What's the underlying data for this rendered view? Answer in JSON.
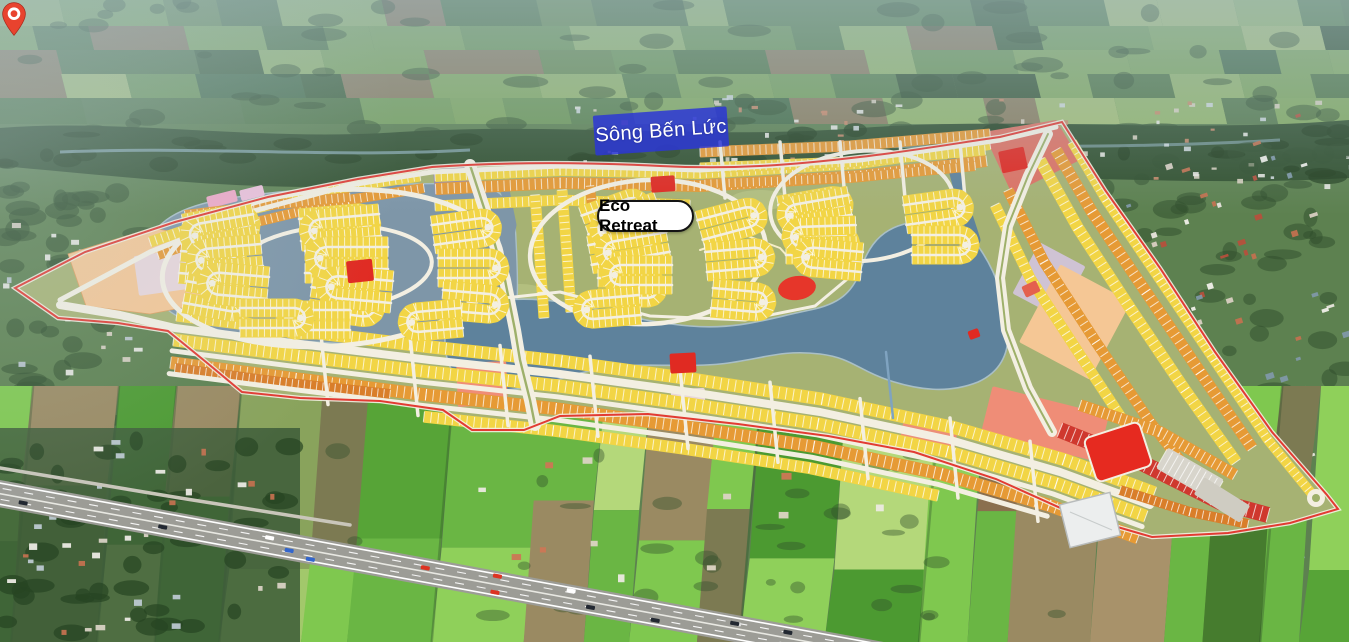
{
  "labels": {
    "river": {
      "text": "Sông Bến Lức"
    },
    "project": {
      "text": "Eco Retreat"
    }
  },
  "marker": {
    "type": "map-pin"
  },
  "palette": {
    "river_label_bg": "#2b36d6",
    "river_label_text": "#ffffff",
    "project_label_bg": "#ffffff",
    "project_label_border": "#141414",
    "project_label_text": "#000000",
    "pin_red": "#e8432e",
    "pin_ring": "#ffffff",
    "highlight_red": "#e6362a",
    "plan_base_green": "#a6b273",
    "lake_blue": "#5e829c",
    "lagoon_blue": "#7e96a8",
    "plot_yellow": "#f2d545",
    "plot_orange": "#e69a35",
    "plot_deep_orange": "#d97e2a",
    "road_cream": "#f3efe2",
    "boundary_red": "#e23b33",
    "red_block": "#e02a22",
    "salmon": "#ef8d77",
    "salmon_red": "#dd7263",
    "pink": "#f0a8c6",
    "light_pink": "#edc0da",
    "pale_pink": "#e8d6da",
    "peach": "#f5c795",
    "purple_block": "#998bab",
    "pale_mauve": "#cfc3d4",
    "field_green": "#6fa24f",
    "field_bright_green": "#7fc84f",
    "field_brown": "#9a8a62",
    "tree_dark": "#2f4e2b",
    "haze_blue": "#a8bfd0",
    "highway_gray": "#9c9c96",
    "river_water": "#8fb0ba",
    "gray_hatch": "#d8d5cc"
  }
}
